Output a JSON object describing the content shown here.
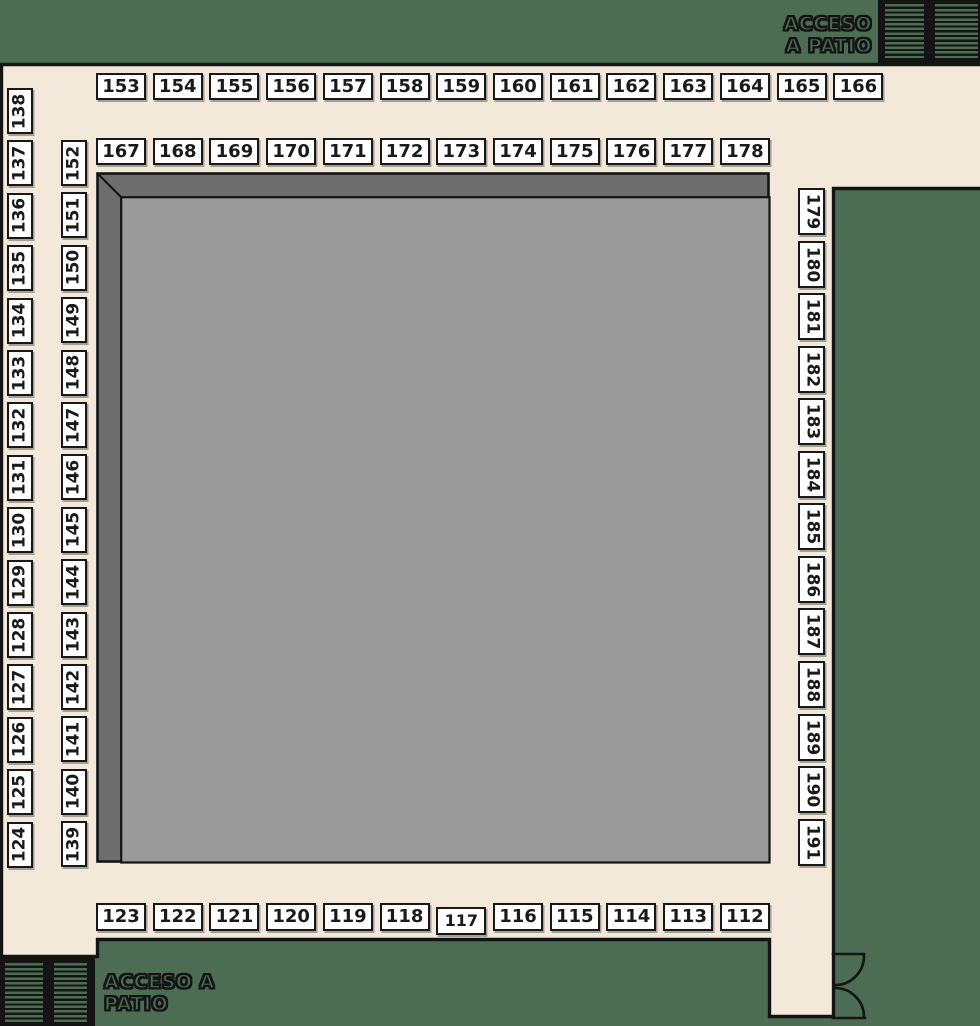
{
  "floor_plan": {
    "labels": {
      "access_top_right": {
        "line1": "ACCESO",
        "line2": "A PATIO"
      },
      "access_bottom_left": {
        "line1": "ACCESO A",
        "line2": "PATIO"
      }
    },
    "stall_groups": {
      "top_row_outer": {
        "stalls": [
          "153",
          "154",
          "155",
          "156",
          "157",
          "158",
          "159",
          "160",
          "161",
          "162",
          "163",
          "164",
          "165",
          "166"
        ]
      },
      "top_row_inner": {
        "stalls": [
          "167",
          "168",
          "169",
          "170",
          "171",
          "172",
          "173",
          "174",
          "175",
          "176",
          "177",
          "178"
        ]
      },
      "left_col_outer": {
        "stalls": [
          "138",
          "137",
          "136",
          "135",
          "134",
          "133",
          "132",
          "131",
          "130",
          "129",
          "128",
          "127",
          "126",
          "125",
          "124"
        ]
      },
      "left_col_inner": {
        "stalls": [
          "152",
          "151",
          "150",
          "149",
          "148",
          "147",
          "146",
          "145",
          "144",
          "143",
          "142",
          "141",
          "140",
          "139"
        ]
      },
      "right_col": {
        "stalls": [
          "179",
          "180",
          "181",
          "182",
          "183",
          "184",
          "185",
          "186",
          "187",
          "188",
          "189",
          "190",
          "191"
        ]
      },
      "bottom_row": {
        "stalls": [
          "123",
          "122",
          "121",
          "120",
          "119",
          "118",
          "117",
          "116",
          "115",
          "114",
          "113",
          "112"
        ]
      }
    },
    "colors": {
      "background_green": "#4c6d53",
      "floor_cream": "#f3e9da",
      "courtyard_frame_gray": "#6e6e6e",
      "courtyard_inner_gray": "#9a9a9a",
      "stall_fill": "#ffffff",
      "line_black": "#141414"
    }
  }
}
